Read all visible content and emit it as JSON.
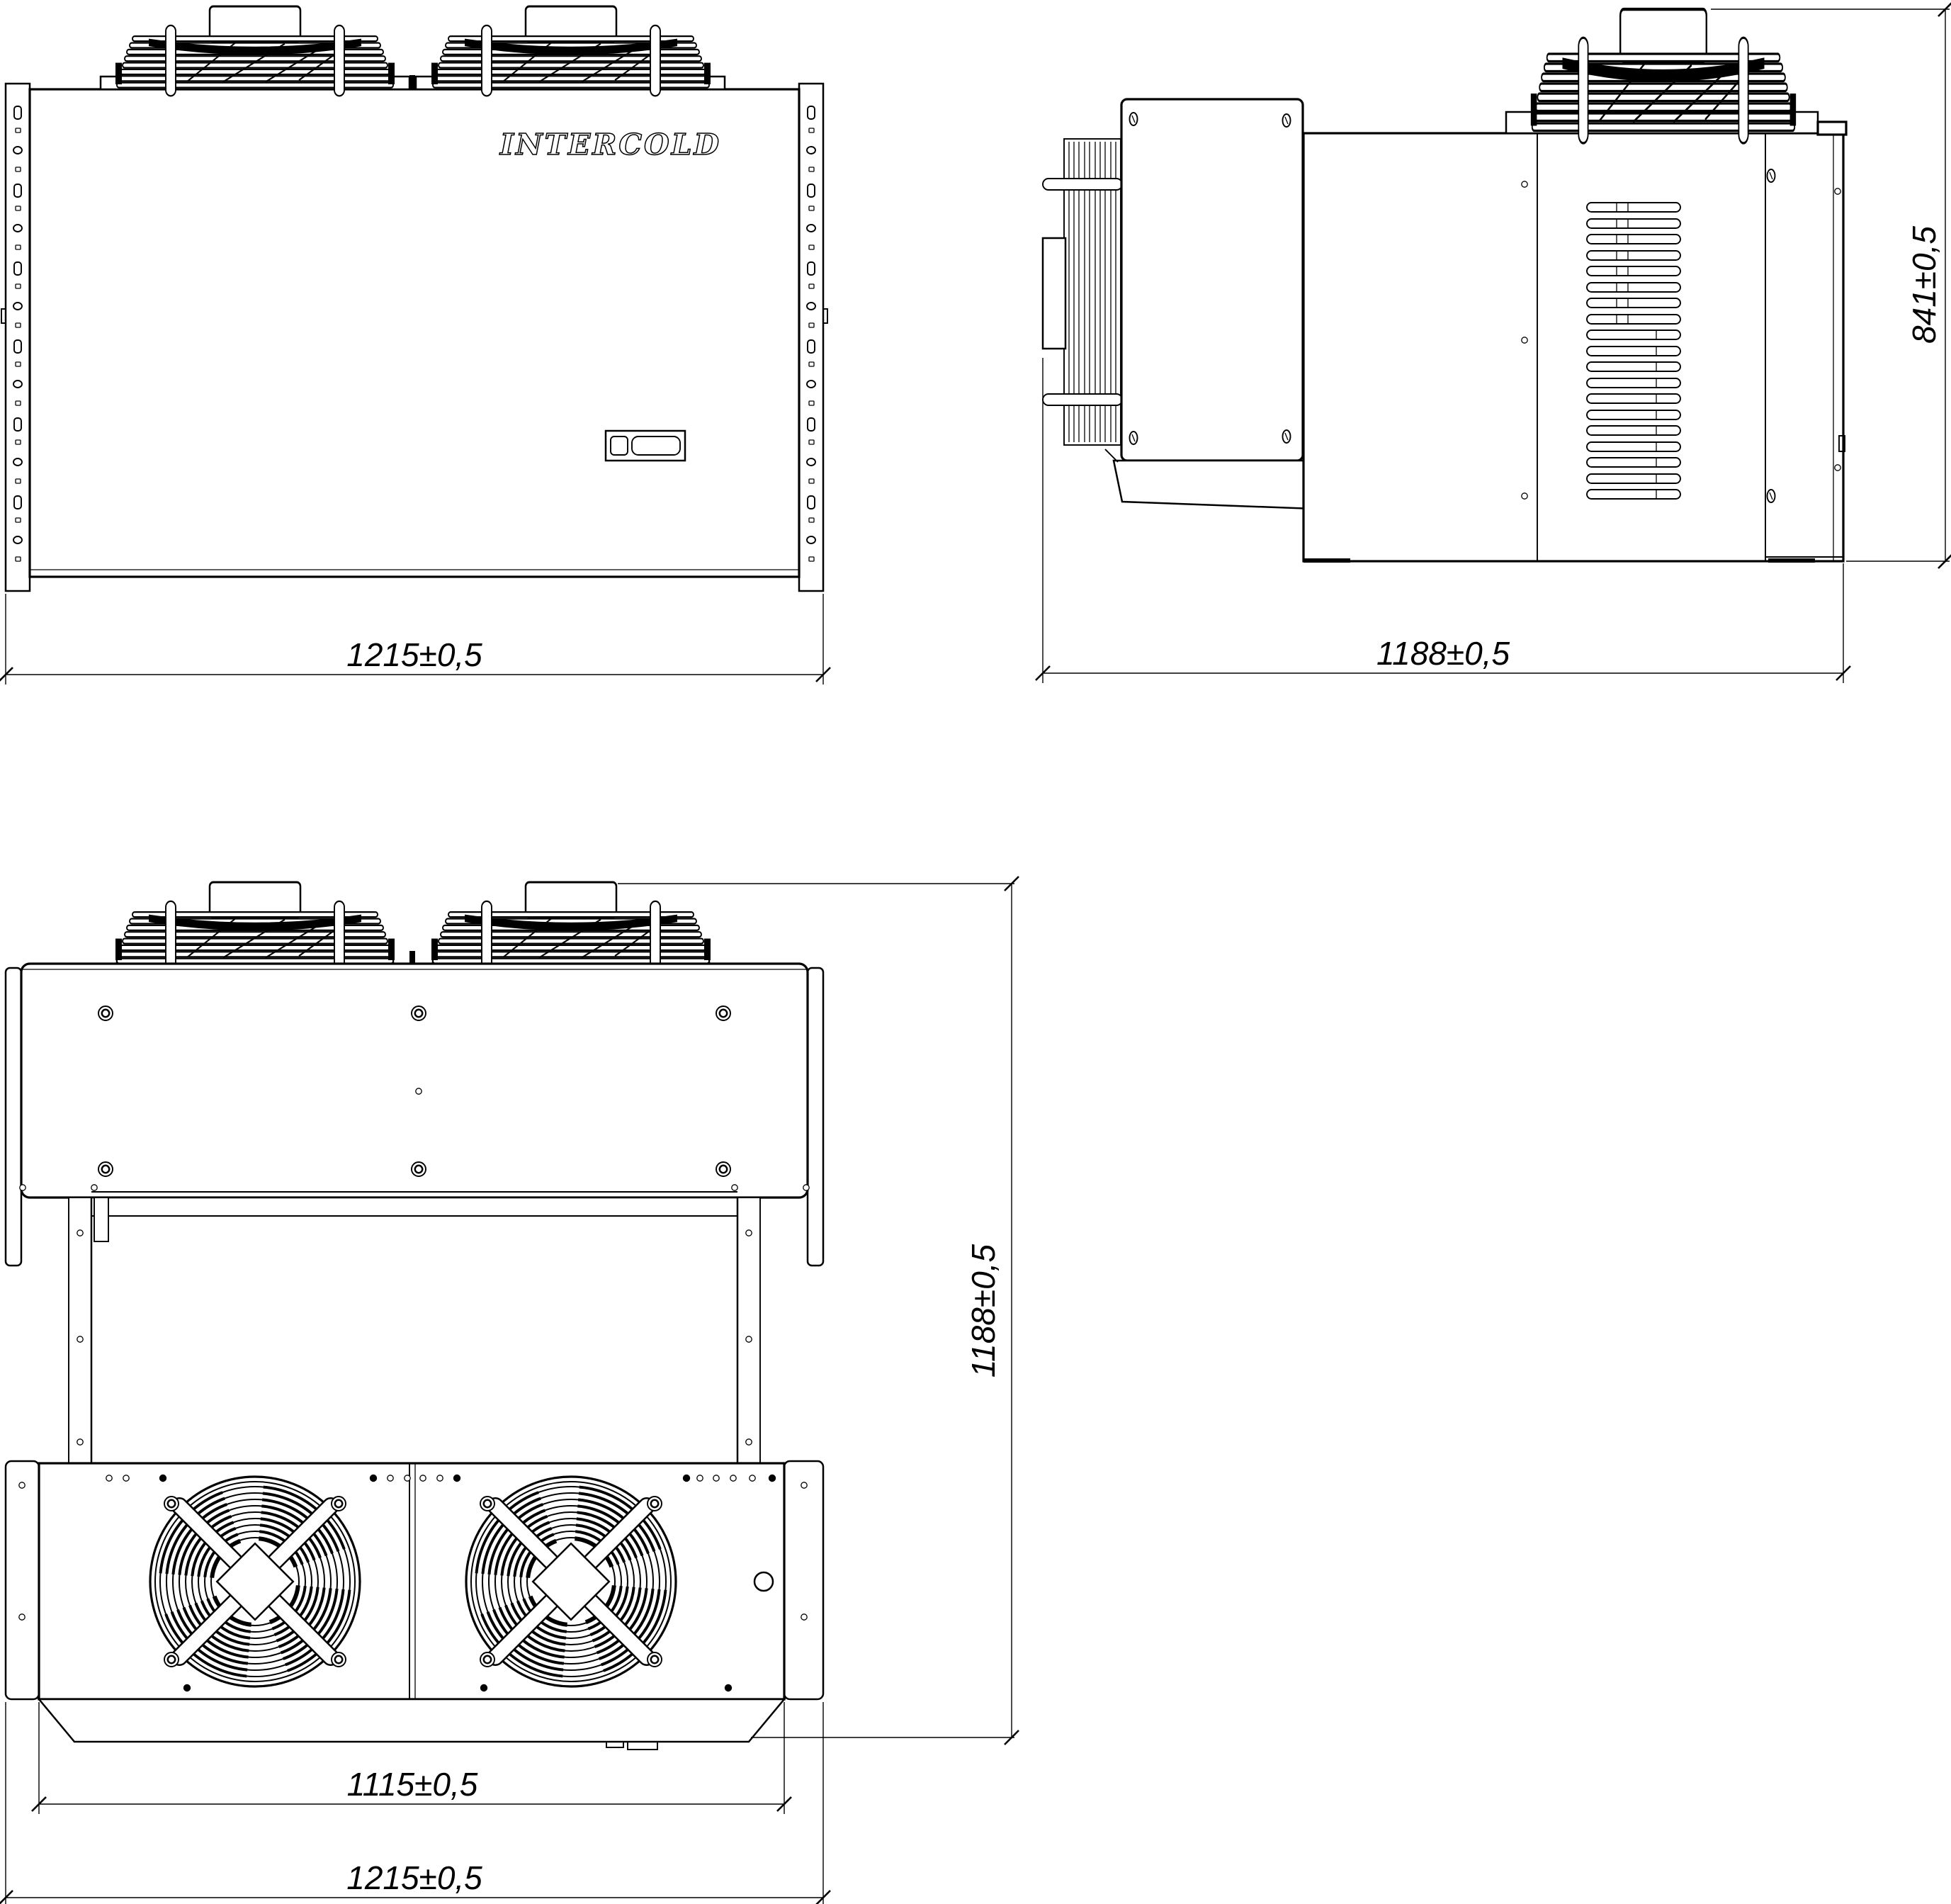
{
  "drawing": {
    "brand": "INTERCOLD",
    "background_color": "#ffffff",
    "line_color": "#000000",
    "views": {
      "front": {
        "width_dim": "1215±0,5"
      },
      "side": {
        "depth_dim": "1188±0,5",
        "height_dim": "841±0,5"
      },
      "plan": {
        "fan_section_width_dim": "1115±0,5",
        "width_dim": "1215±0,5",
        "depth_dim": "1188±0,5"
      }
    }
  }
}
